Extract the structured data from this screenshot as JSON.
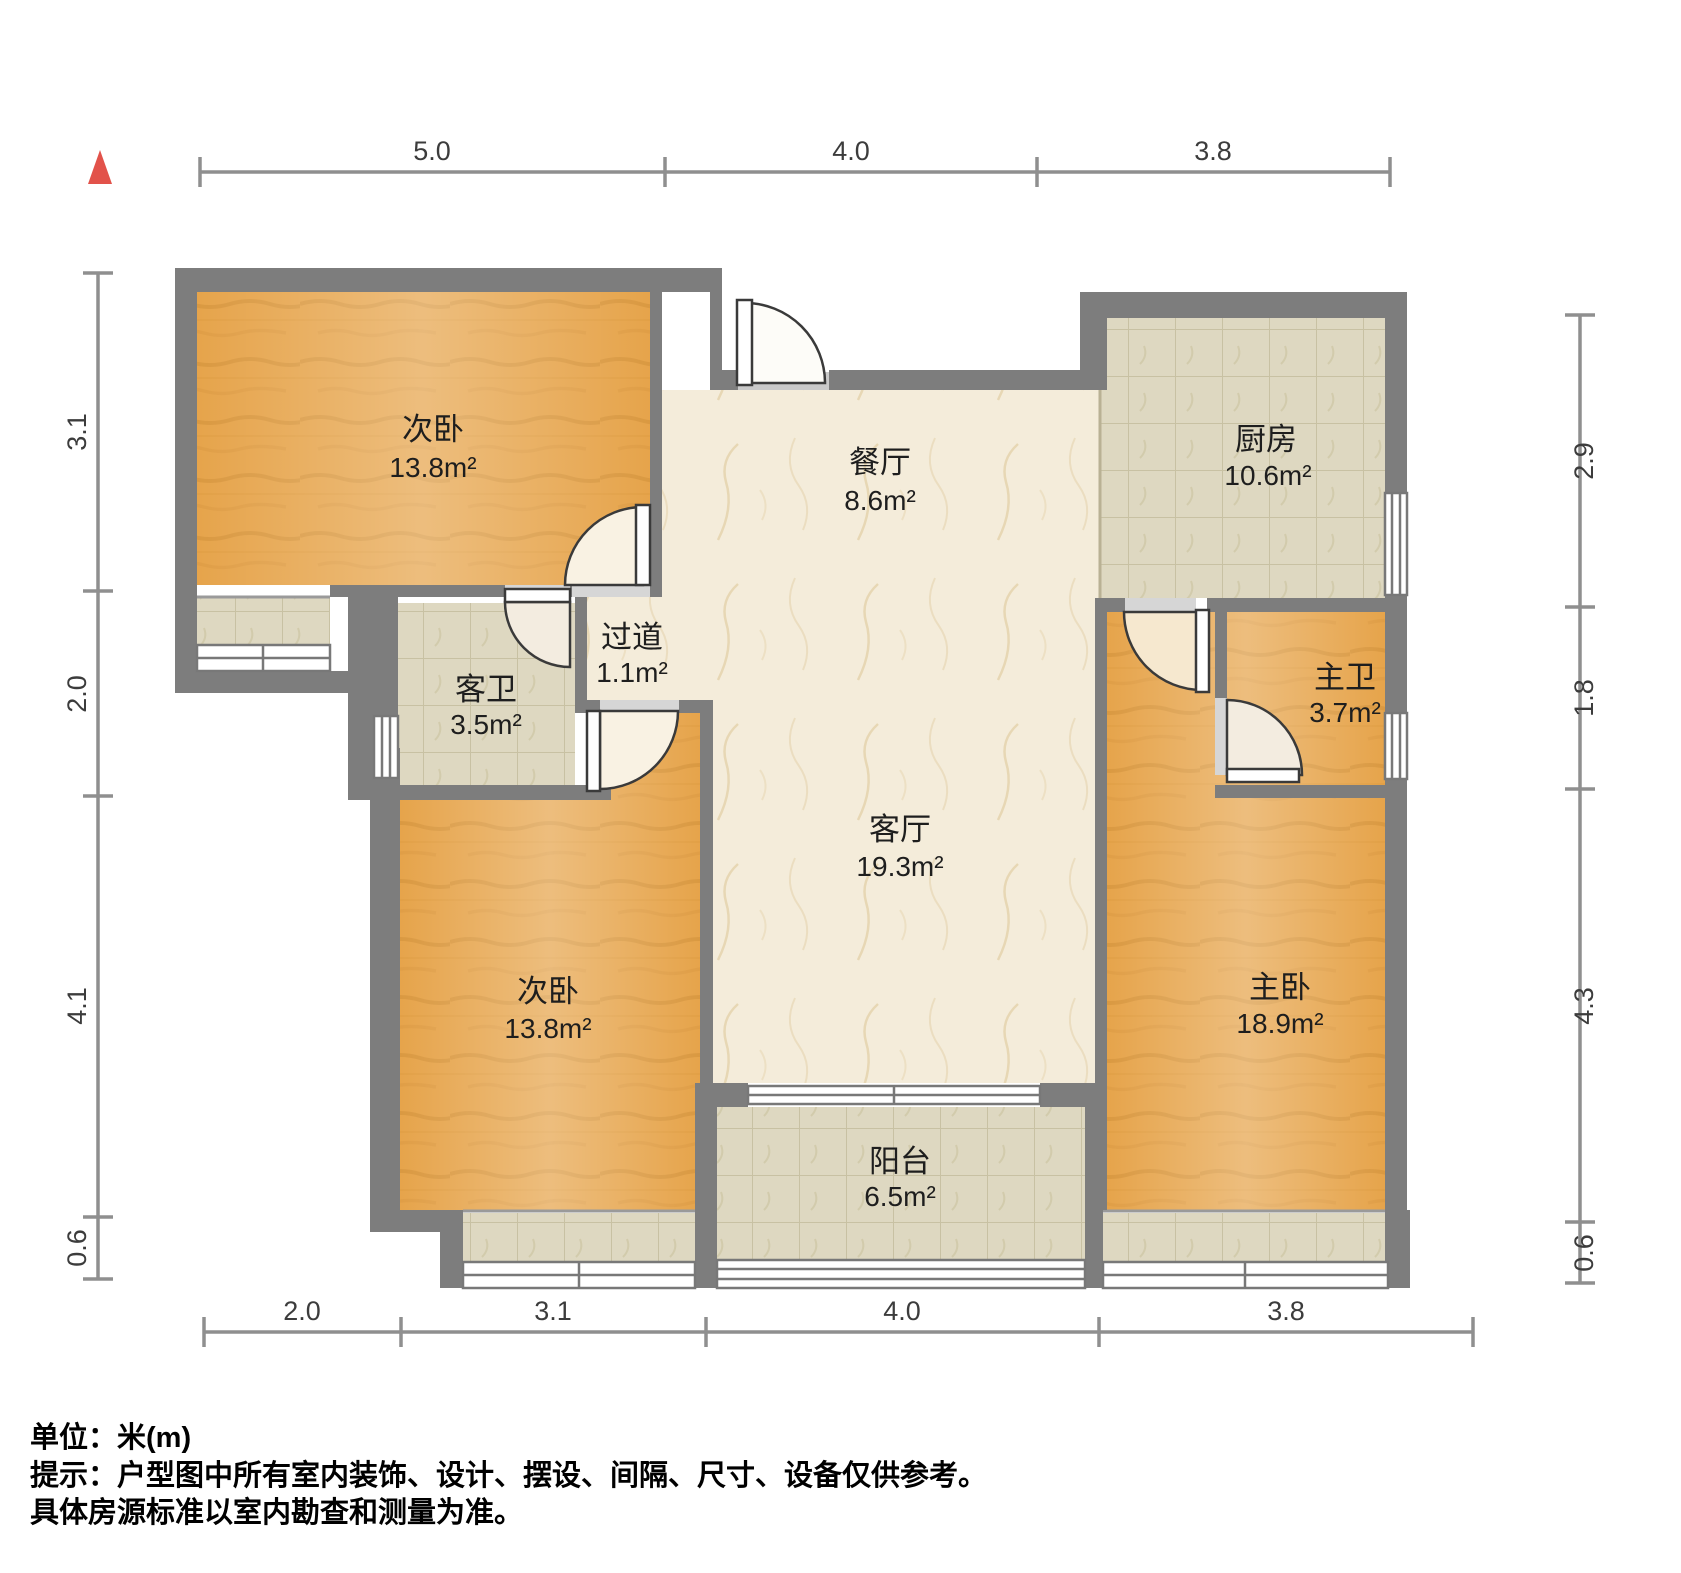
{
  "rooms": {
    "bedroom_top": {
      "name": "次卧",
      "area": "13.8m²"
    },
    "dining": {
      "name": "餐厅",
      "area": "8.6m²"
    },
    "kitchen": {
      "name": "厨房",
      "area": "10.6m²"
    },
    "guest_bath": {
      "name": "客卫",
      "area": "3.5m²"
    },
    "hallway": {
      "name": "过道",
      "area": "1.1m²"
    },
    "living": {
      "name": "客厅",
      "area": "19.3m²"
    },
    "master_bath": {
      "name": "主卫",
      "area": "3.7m²"
    },
    "bedroom_bottom": {
      "name": "次卧",
      "area": "13.8m²"
    },
    "master_bedroom": {
      "name": "主卧",
      "area": "18.9m²"
    },
    "balcony": {
      "name": "阳台",
      "area": "6.5m²"
    }
  },
  "dimensions": {
    "top": [
      "5.0",
      "4.0",
      "3.8"
    ],
    "bottom": [
      "2.0",
      "3.1",
      "4.0",
      "3.8"
    ],
    "left": [
      "3.1",
      "2.0",
      "4.1",
      "0.6"
    ],
    "right": [
      "2.9",
      "1.8",
      "4.3",
      "0.6"
    ]
  },
  "footer": {
    "unit_line": "单位：米(m)",
    "tip_line1": "提示：户型图中所有室内装饰、设计、摆设、间隔、尺寸、设备仅供参考。",
    "tip_line2": "具体房源标准以室内勘查和测量为准。"
  },
  "colors": {
    "wall": "#7d7d7d",
    "wood_floor": "#e6a44b",
    "tile_floor": "#ded8c1",
    "marble_floor": "#f4ecda",
    "north_marker": "#e2524a",
    "dimension_line": "#8f8f8f"
  }
}
